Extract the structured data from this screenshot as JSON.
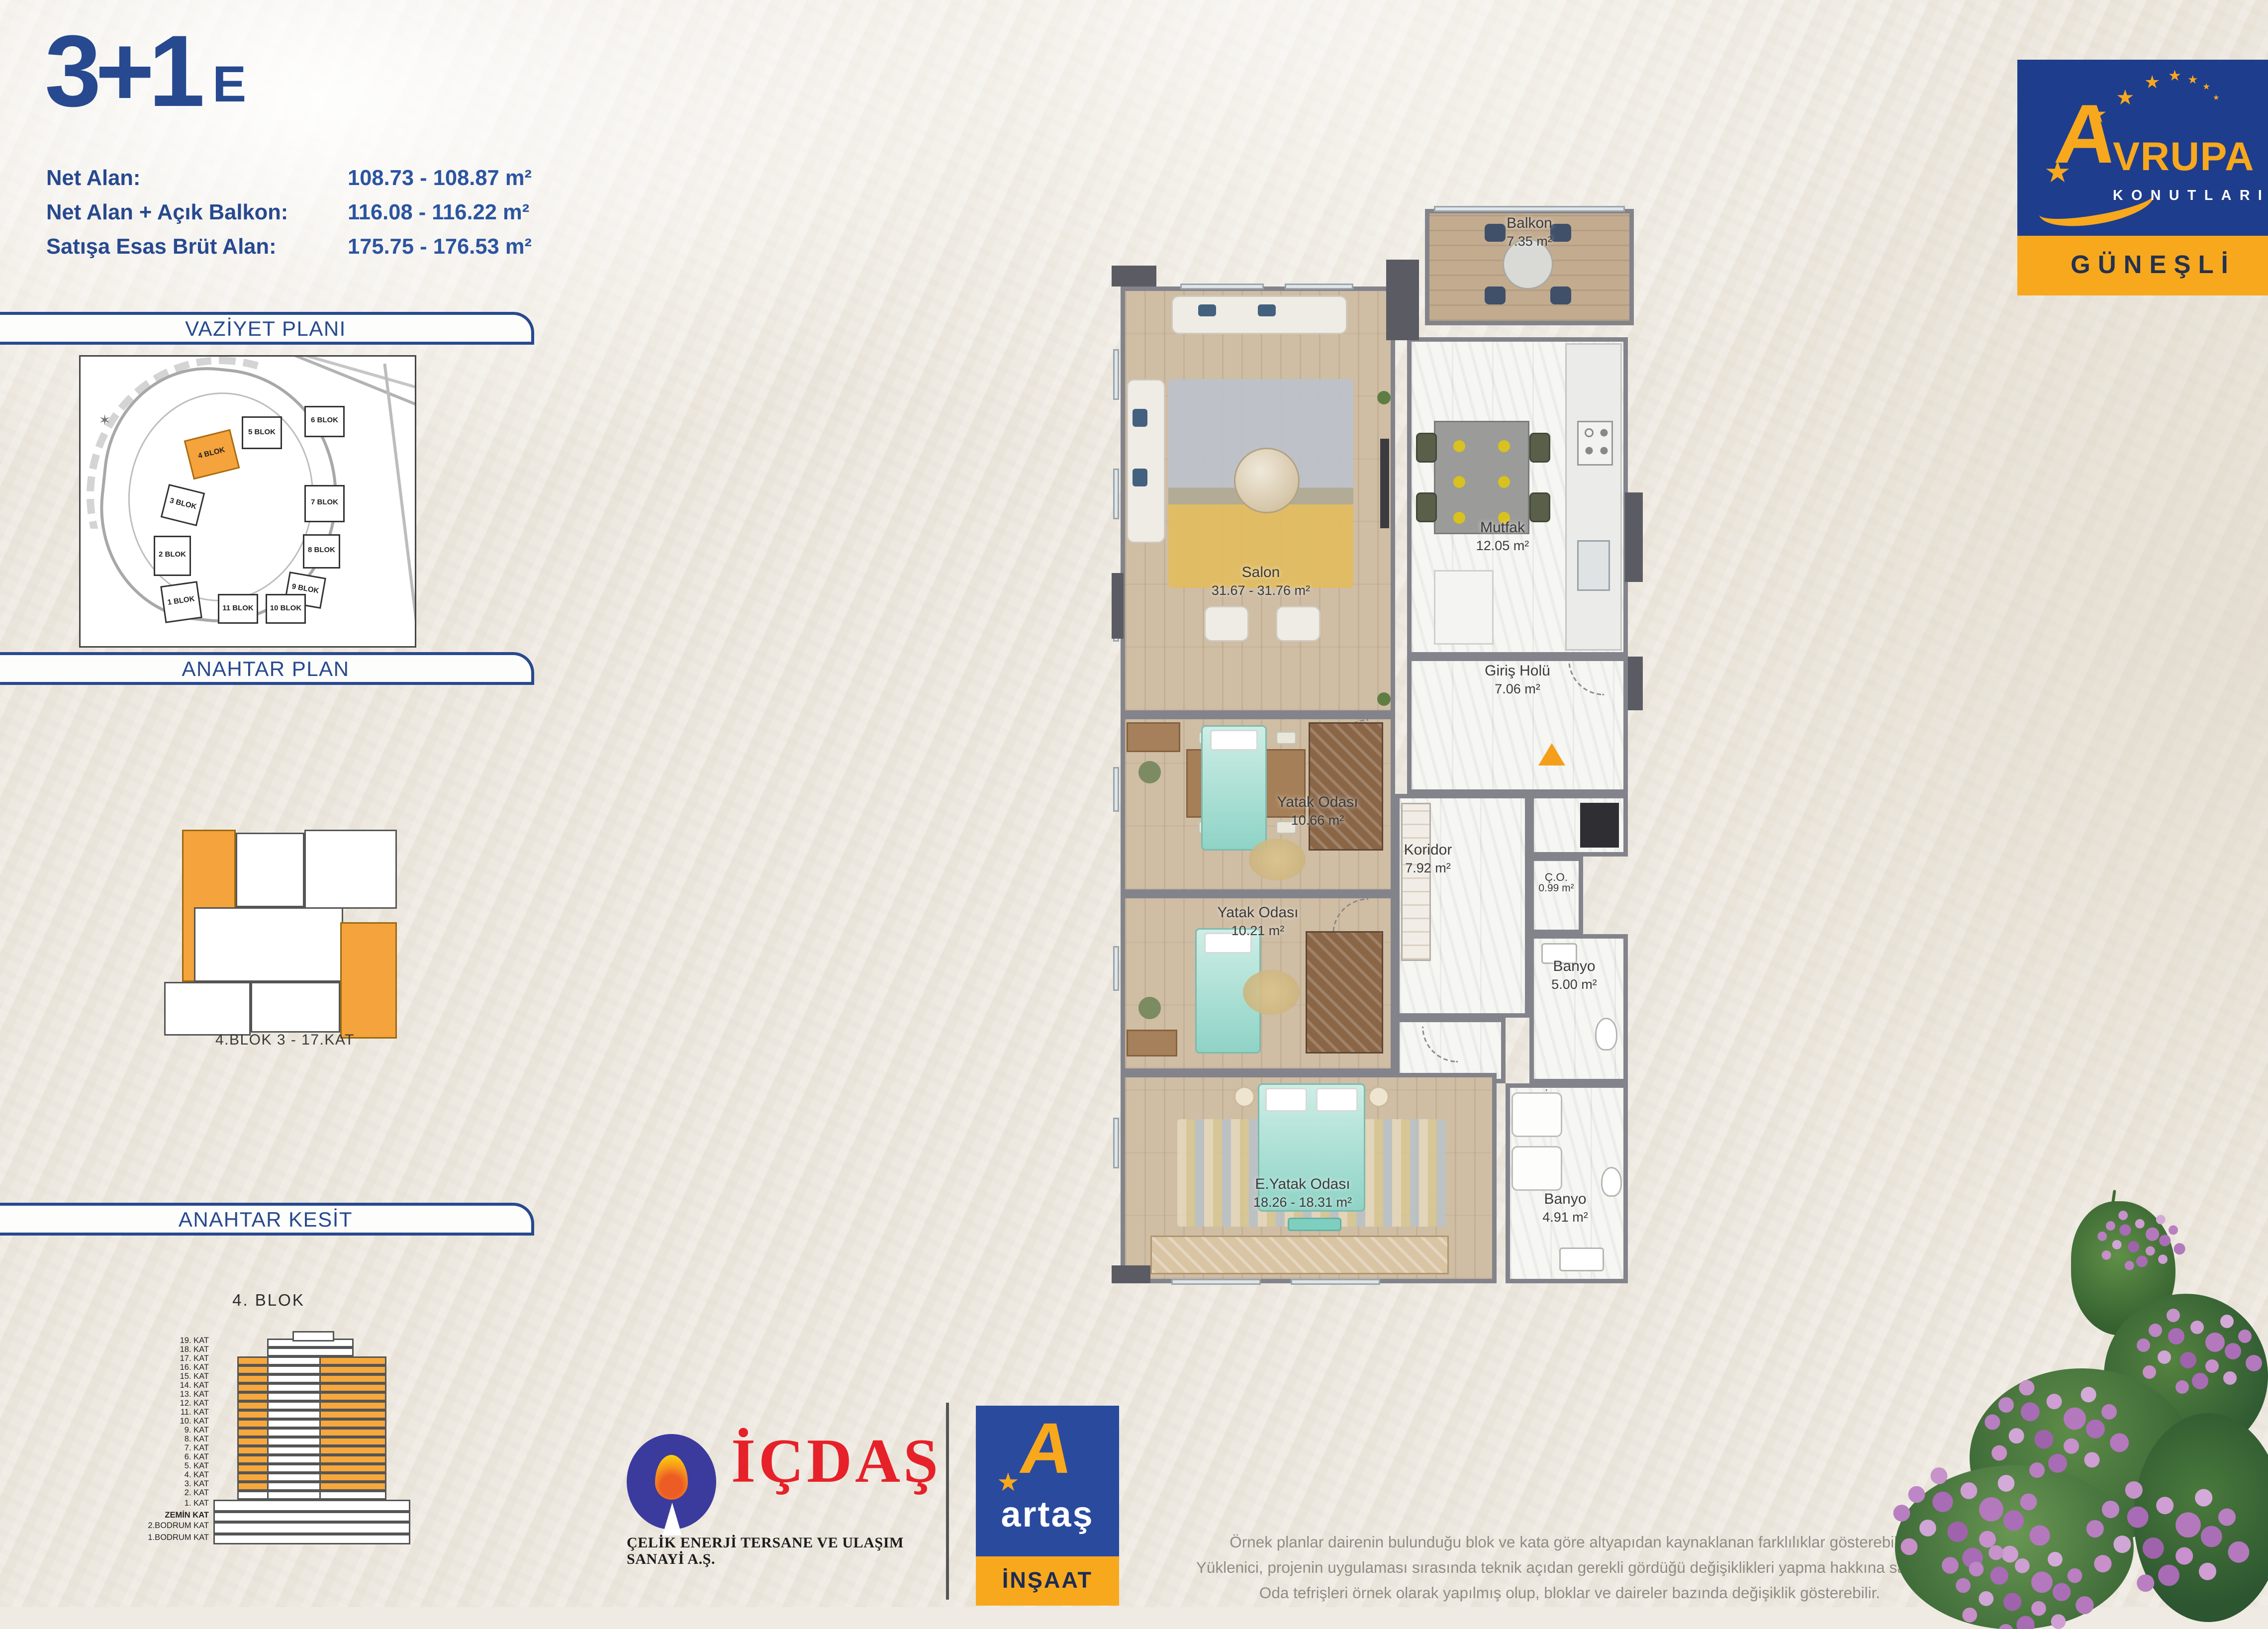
{
  "unit": {
    "type": "3+1",
    "variant": "E"
  },
  "areas": [
    {
      "label": "Net Alan:",
      "value": "108.73 - 108.87 m²"
    },
    {
      "label": "Net Alan + Açık Balkon:",
      "value": "116.08 - 116.22 m²"
    },
    {
      "label": "Satışa Esas Brüt Alan:",
      "value": "175.75 - 176.53 m²"
    }
  ],
  "site_plan": {
    "title": "VAZİYET PLANI",
    "highlighted_block": "4 BLOK",
    "blocks": [
      {
        "label": "1 BLOK"
      },
      {
        "label": "2 BLOK"
      },
      {
        "label": "3 BLOK"
      },
      {
        "label": "4 BLOK"
      },
      {
        "label": "5 BLOK"
      },
      {
        "label": "6 BLOK"
      },
      {
        "label": "7 BLOK"
      },
      {
        "label": "8 BLOK"
      },
      {
        "label": "9 BLOK"
      },
      {
        "label": "10 BLOK"
      },
      {
        "label": "11 BLOK"
      }
    ]
  },
  "key_plan": {
    "title": "ANAHTAR PLAN",
    "caption": "4.BLOK  3 - 17.KAT"
  },
  "key_section": {
    "title": "ANAHTAR KESİT",
    "caption": "4. BLOK",
    "highlight_range": "3. KAT - 17. KAT",
    "floors": [
      "19. KAT",
      "18. KAT",
      "17. KAT",
      "16. KAT",
      "15. KAT",
      "14. KAT",
      "13. KAT",
      "12. KAT",
      "11. KAT",
      "10. KAT",
      "9. KAT",
      "8. KAT",
      "7. KAT",
      "6. KAT",
      "5. KAT",
      "4. KAT",
      "3. KAT",
      "2. KAT",
      "1. KAT",
      "ZEMİN KAT",
      "2.BODRUM KAT",
      "1.BODRUM KAT"
    ]
  },
  "floor_plan": {
    "rooms": [
      {
        "name": "Balkon",
        "area": "7.35 m²"
      },
      {
        "name": "Salon",
        "area": "31.67 - 31.76 m²"
      },
      {
        "name": "Mutfak",
        "area": "12.05 m²"
      },
      {
        "name": "Giriş Holü",
        "area": "7.06 m²"
      },
      {
        "name": "Yatak Odası",
        "area": "10.66 m²"
      },
      {
        "name": "Koridor",
        "area": "7.92 m²"
      },
      {
        "name": "Ç.O.",
        "area": "0.99 m²"
      },
      {
        "name": "Yatak Odası",
        "area": "10.21 m²"
      },
      {
        "name": "Banyo",
        "area": "5.00 m²"
      },
      {
        "name": "E.Yatak Odası",
        "area": "18.26 - 18.31 m²"
      },
      {
        "name": "Banyo",
        "area": "4.91 m²"
      }
    ],
    "entrance_marker": "▲"
  },
  "brand": {
    "initial": "A",
    "rest": "VRUPA",
    "line2": "KONUTLARI",
    "location": "GÜNEŞLİ"
  },
  "partners": {
    "icdas": {
      "name": "İÇDAŞ",
      "subtitle": "ÇELİK ENERJİ TERSANE VE ULAŞIM SANAYİ A.Ş."
    },
    "artas": {
      "name": "artaş",
      "subtitle": "İNŞAAT"
    }
  },
  "disclaimer": {
    "lines": [
      "Örnek planlar dairenin bulunduğu blok ve kata göre altyapıdan kaynaklanan farklılıklar gösterebilir.",
      "Yüklenici, projenin uygulaması sırasında teknik açıdan gerekli gördüğü değişiklikleri yapma hakkına sahiptir.",
      "Oda tefrişleri örnek olarak yapılmış olup, bloklar ve daireler bazında değişiklik gösterebilir."
    ]
  },
  "colors": {
    "navy": "#27498f",
    "orange": "#f5a33c",
    "logo_blue": "#1e3d8d",
    "logo_yellow": "#f7a81d",
    "icdas_red": "#e62129"
  }
}
